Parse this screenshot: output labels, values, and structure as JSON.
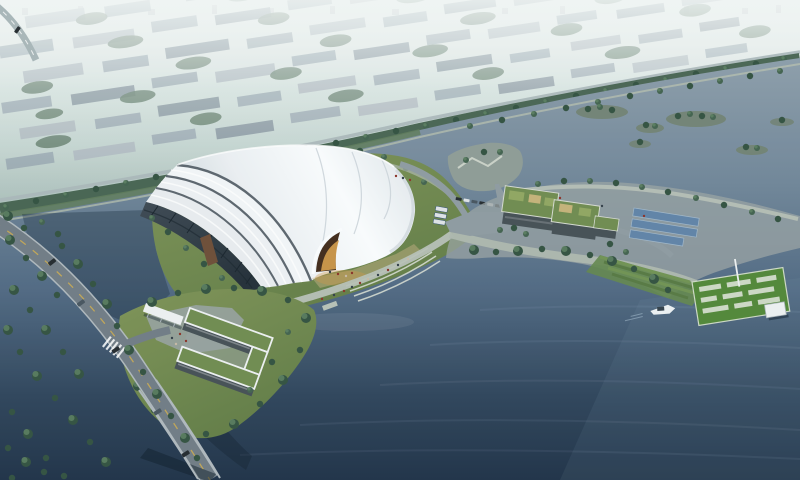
{
  "scene": {
    "type": "aerial-architectural-rendering",
    "description": "Dusk bird's-eye view of a white wave-shell exhibition hall on a lakefront lawn island, with glowing amber entrance, waterfront promenade and stairs, green-roof office blocks with buses and roadside parking, a tree-lined avenue shielding a hazy low-rise city grid, wooded islands in the river, a lawn pier with white pavilion and a single white boat, an L-shaped green-roof building beside a foreground road that bridges a dark channel",
    "time_of_day": "dusk-haze",
    "counts": {
      "boats": 1,
      "buses": 3,
      "road_cars": 5,
      "parked_cars": 6,
      "tree_islands": 6,
      "shell_roof_bands": 3
    },
    "colors": {
      "sky_top": "#f2f6f5",
      "haze": "#c6d7d2",
      "haze_deep": "#a3b8b3",
      "white": "#ffffff",
      "shadow": "#0a1826",
      "skyline": "#8b98a1",
      "city_wall": "#93a3ac",
      "city_wall_light": "#a8b3ba",
      "city_wall_dark": "#7e8e98",
      "city_tree": "#4c6a56",
      "tree_dark": "#2f4e3d",
      "tree_mid": "#3f5f4b",
      "tree_light": "#5d8160",
      "avenue_band": "#3e5c49",
      "road_light": "#a8b6b8",
      "bank_green": "#5d7a58",
      "bank_sand": "#b9c2ae",
      "water_top": "#8b9ca9",
      "water_upper": "#6d8396",
      "water_mid": "#4d6680",
      "water_low": "#2b4158",
      "water_deep": "#1b2e44",
      "water_sheen": "#7e9ab0",
      "pond_dark": "#122536",
      "channel_dark": "#0e1e2e",
      "ripple": "#bcd2e2",
      "island_base": "#6f7f6e",
      "lawn": "#7d9254",
      "lawn_dark": "#5f7a42",
      "roof_white": "#fbfdfe",
      "roof_mid": "#ecf0f3",
      "roof_shade": "#c9d2d8",
      "roof_east": "#e2e8ec",
      "roof_band1": "#e9edf0",
      "roof_band2": "#eef1f4",
      "roof_band3": "#f3f6f8",
      "groove": "#59636b",
      "seam": "#ccd4da",
      "glass_top": "#3a4650",
      "glass_bottom": "#1f2b34",
      "glass_stripe": "#141f28",
      "accent_brown": "#6b4a33",
      "entry_dark": "#3f2817",
      "entry_glow": "#cf9746",
      "plaza_warm": "#c9b183",
      "promenade": "#b7c0b6",
      "promenade_light": "#d5dad0",
      "plaza_gray": "#98a2a2",
      "walk_gray": "#adb7ad",
      "road_mid": "#8d99a0",
      "road_fore": "#6e7a83",
      "road_edge": "#aeb7bc",
      "lane_yellow": "#c9a84f",
      "car_dark": "#20262b",
      "car_white": "#dfe3e6",
      "car_gray": "#44525c",
      "bus_stripe": "#3c5a74",
      "office_wall": "#424c52",
      "office_roof": "#6d8a4c",
      "patch_light": "#8fa55e",
      "patch_tan": "#c4b177",
      "panel_blue": "#5d81a6",
      "panel_edge": "#9fb6c9",
      "pier_green": "#4e8534",
      "pier_path": "#cdd8c4",
      "pavilion_white": "#eef1f2",
      "pavilion_edge": "#aab4ba",
      "boat_white": "#edf1f3",
      "boat_cabin": "#2f3d47",
      "slope_a": "#54763f",
      "slope_b": "#6e9150",
      "slope_base": "#61854a",
      "spit_gray": "#8d9a94",
      "people_red": "#8a2e23",
      "people_dark": "#2e3a44",
      "people_tan": "#c8b9a4"
    }
  }
}
